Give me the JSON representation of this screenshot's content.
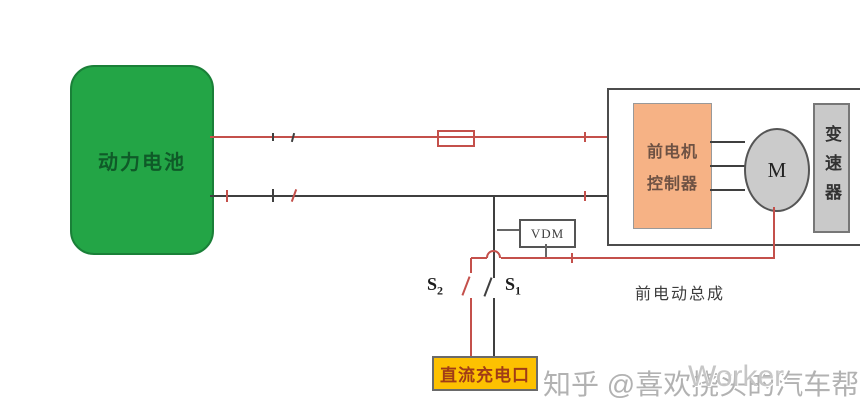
{
  "battery": {
    "label": "动力电池"
  },
  "assembly": {
    "caption": "前电动总成"
  },
  "controller": {
    "line1": "前电机",
    "line2": "控制器"
  },
  "motor": {
    "label": "M"
  },
  "transmission": {
    "label": "变速器"
  },
  "vdm": {
    "label": "VDM"
  },
  "switches": {
    "s2_base": "S",
    "s2_sub": "2",
    "s1_base": "S",
    "s1_sub": "1"
  },
  "charge_port": {
    "label": "直流充电口"
  },
  "watermark": {
    "main": "知乎 @喜欢挠头的汽车帮",
    "overlay": "Worker"
  },
  "colors": {
    "battery_fill": "#23a546",
    "controller_fill": "#f6b285",
    "component_gray": "#cbcbcb",
    "charge_port_fill": "#fdc101",
    "wire_red": "#c4504b",
    "wire_dark": "#3f3f3f"
  }
}
